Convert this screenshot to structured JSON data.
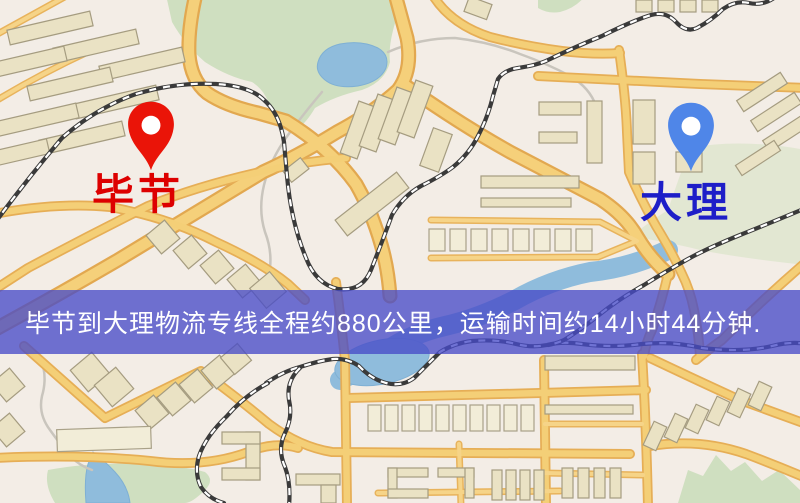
{
  "page": {
    "width": 800,
    "height": 503,
    "kind": "logistics-route-map"
  },
  "map": {
    "origin": {
      "label": "毕节",
      "label_color": "#dd0000",
      "pin_icon": "map-pin-icon",
      "pin_color": "#ea1408"
    },
    "destination": {
      "label": "大理",
      "label_color": "#1e1ec8",
      "pin_icon": "map-pin-icon",
      "pin_color": "#4f86e8"
    },
    "banner": {
      "text": "毕节到大理物流专线全程约880公里，运输时间约14小时44分钟.",
      "distance_text": "约880公里",
      "duration_text": "约14小时44分钟",
      "background": "rgba(72,76,200,0.78)",
      "text_color": "#ffffff"
    },
    "palette": {
      "background": "#f3ede6",
      "road_fill": "#f5d07a",
      "road_casing": "#e2a850",
      "park_green": "#cfdfc0",
      "water_blue": "#8fbcdc",
      "building_tan": "#eae2c4",
      "railway_dark": "#3a3a3a"
    }
  }
}
